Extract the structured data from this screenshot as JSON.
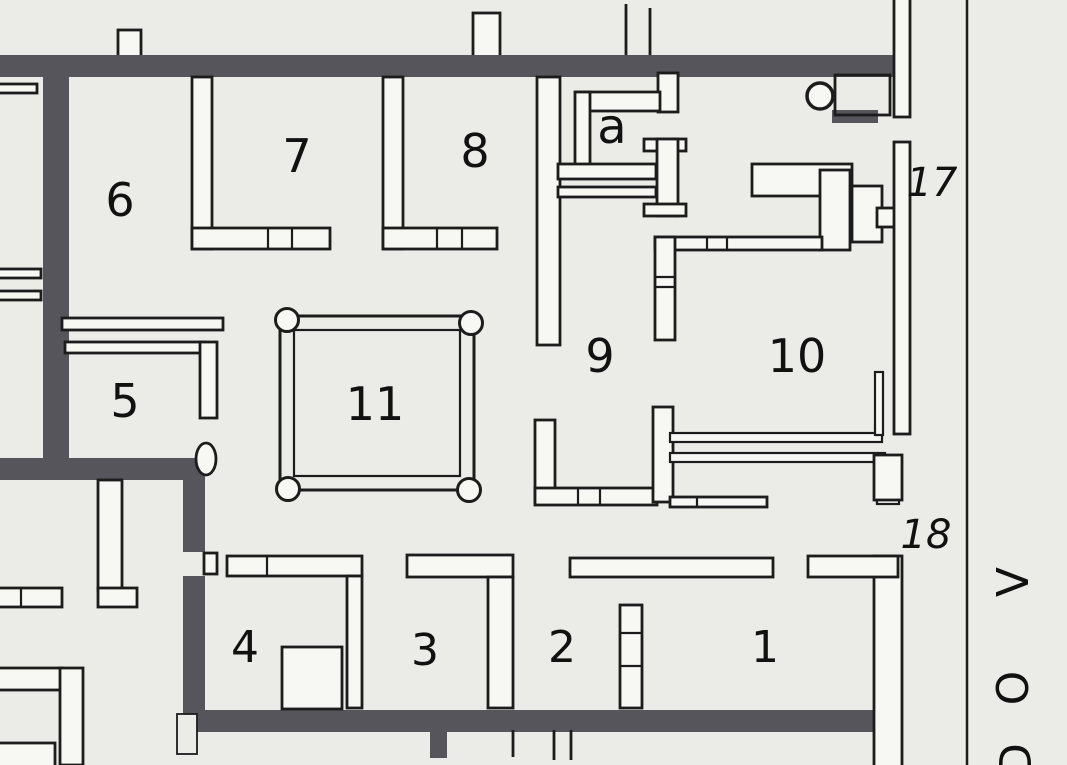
{
  "plan": {
    "type": "archaeological-floor-plan",
    "rooms": {
      "r1": {
        "label": "1"
      },
      "r2": {
        "label": "2"
      },
      "r3": {
        "label": "3"
      },
      "r4": {
        "label": "4"
      },
      "r5": {
        "label": "5"
      },
      "r6": {
        "label": "6"
      },
      "r7": {
        "label": "7"
      },
      "r8": {
        "label": "8"
      },
      "r9": {
        "label": "9"
      },
      "r10": {
        "label": "10"
      },
      "r11": {
        "label": "11"
      },
      "ra": {
        "label": "a"
      }
    },
    "entrances": {
      "e17": {
        "label": "17"
      },
      "e18": {
        "label": "18"
      }
    },
    "street_label": {
      "char1": "V",
      "char2": "O",
      "char3": "D"
    },
    "colors": {
      "paper": "#ebebe8",
      "thick_wall": "#55555b",
      "line": "#1c1c1c",
      "thin_wall_fill": "#f7f7f4"
    }
  }
}
